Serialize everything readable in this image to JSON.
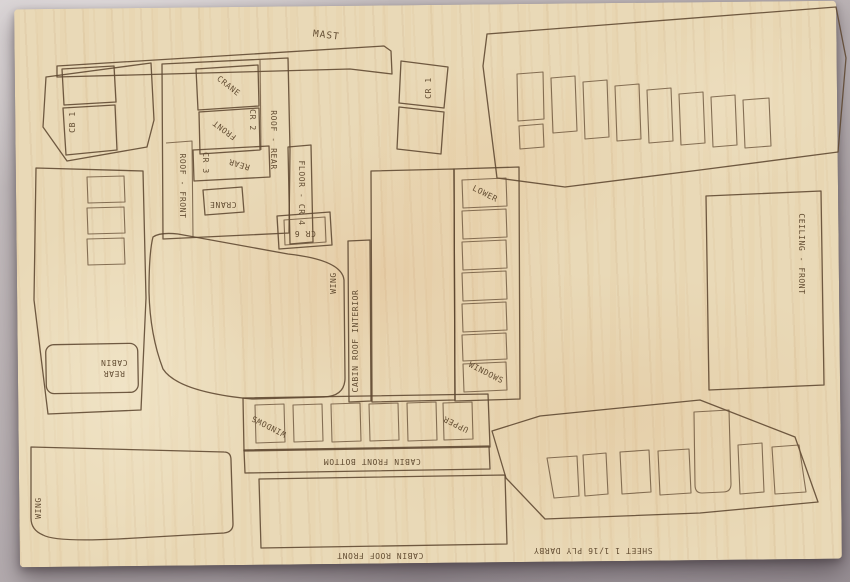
{
  "labels": {
    "mast": "MAST",
    "cb_1": "CB 1",
    "crane_roof": "CRANE",
    "front": "FRONT",
    "cr_2": "CR 2",
    "roof_rear": "ROOF - REAR",
    "roof_front": "ROOF - FRONT",
    "cr_3": "CR 3",
    "rear": "REAR",
    "crane_floor": "CRANE",
    "floor_cr_4": "FLOOR - CR 4",
    "cr_6": "CR 6",
    "cr_1": "CR 1",
    "wing_center": "WING",
    "cabin_roof_interior": "CABIN ROOF INTERIOR",
    "lower": "LOWER",
    "windows_side": "WINDOWS",
    "cabin_rear_line1": "CABIN",
    "cabin_rear_line2": "REAR",
    "windows_front": "WINDOWS",
    "upper": "UPPER",
    "cabin_front_bottom": "CABIN FRONT BOTTOM",
    "cabin_roof_front": "CABIN ROOF FRONT",
    "sheet_title": "SHEET 1  1/16 PLY  DARBY",
    "ceiling_front": "CEILING - FRONT",
    "wing_bottom": "WING"
  },
  "colors": {
    "wood": "#e9d9b7",
    "engraving": "#5d4730",
    "fabric": "#b5adb0"
  }
}
